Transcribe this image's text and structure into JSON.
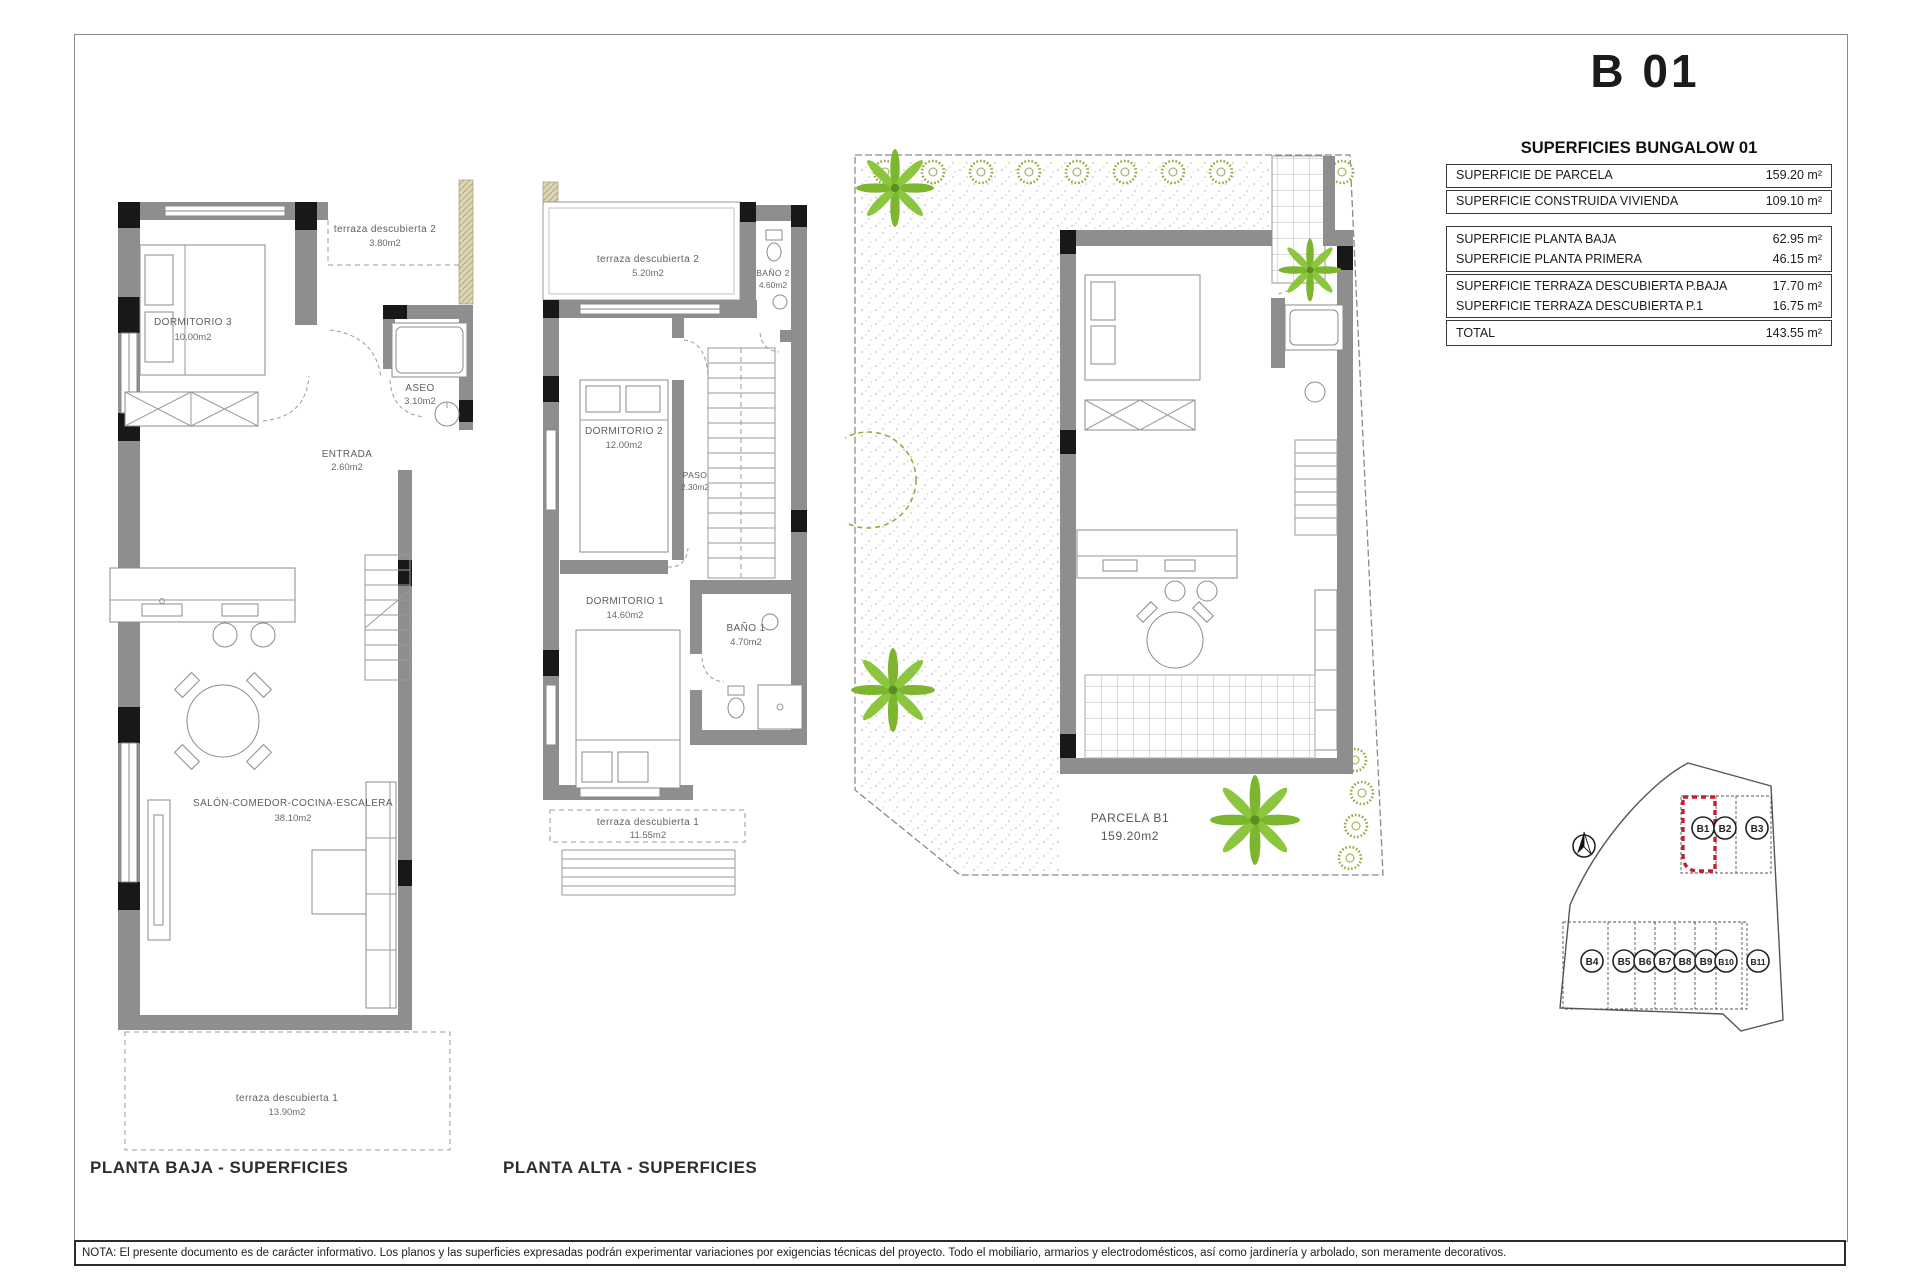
{
  "sheet": {
    "title": "B 01",
    "note": "NOTA: El presente documento es de carácter informativo. Los planos y las superficies expresadas podrán experimentar variaciones por exigencias técnicas del proyecto. Todo el mobiliario, armarios y electrodomésticos, así como jardinería y arbolado, son meramente decorativos."
  },
  "summary_table": {
    "title": "SUPERFICIES BUNGALOW 01",
    "groups": [
      {
        "rows": [
          {
            "label": "SUPERFICIE DE PARCELA",
            "value": "159.20 m²"
          }
        ]
      },
      {
        "rows": [
          {
            "label": "SUPERFICIE CONSTRUIDA VIVIENDA",
            "value": "109.10 m²"
          }
        ]
      },
      {
        "rows": [
          {
            "label": "SUPERFICIE PLANTA BAJA",
            "value": "62.95 m²"
          },
          {
            "label": "SUPERFICIE PLANTA PRIMERA",
            "value": "46.15 m²"
          }
        ]
      },
      {
        "rows": [
          {
            "label": "SUPERFICIE TERRAZA DESCUBIERTA P.BAJA",
            "value": "17.70 m²"
          },
          {
            "label": "SUPERFICIE TERRAZA DESCUBIERTA P.1",
            "value": "16.75 m²"
          }
        ]
      },
      {
        "rows": [
          {
            "label": "TOTAL",
            "value": "143.55 m²"
          }
        ]
      }
    ]
  },
  "ground_floor": {
    "title": "PLANTA BAJA - SUPERFICIES",
    "rooms": {
      "terraza2": {
        "name": "terraza descubierta 2",
        "area": "3.80m2"
      },
      "dormitorio3": {
        "name": "DORMITORIO 3",
        "area": "10.00m2"
      },
      "aseo": {
        "name": "ASEO",
        "area": "3.10m2"
      },
      "entrada": {
        "name": "ENTRADA",
        "area": "2.60m2"
      },
      "salon": {
        "name": "SALÓN-COMEDOR-COCINA-ESCALERA",
        "area": "38.10m2"
      },
      "terraza1": {
        "name": "terraza descubierta 1",
        "area": "13.90m2"
      }
    }
  },
  "upper_floor": {
    "title": "PLANTA ALTA - SUPERFICIES",
    "rooms": {
      "terraza2": {
        "name": "terraza descubierta 2",
        "area": "5.20m2"
      },
      "bano2": {
        "name": "BAÑO 2",
        "area": "4.60m2"
      },
      "dormitorio2": {
        "name": "DORMITORIO 2",
        "area": "12.00m2"
      },
      "paso": {
        "name": "PASO",
        "area": "2.30m2"
      },
      "dormitorio1": {
        "name": "DORMITORIO 1",
        "area": "14.60m2"
      },
      "bano1": {
        "name": "BAÑO 1",
        "area": "4.70m2"
      },
      "terraza1": {
        "name": "terraza descubierta 1",
        "area": "11.55m2"
      }
    }
  },
  "site_plan": {
    "parcel_label": "PARCELA B1",
    "parcel_area": "159.20m2"
  },
  "plot_map": {
    "top_plots": [
      "B1",
      "B2",
      "B3"
    ],
    "bottom_plots": [
      "B4",
      "B5",
      "B6",
      "B7",
      "B8",
      "B9",
      "B10",
      "B11"
    ],
    "highlighted_plot": "B1",
    "highlight_color": "#c5212b"
  }
}
